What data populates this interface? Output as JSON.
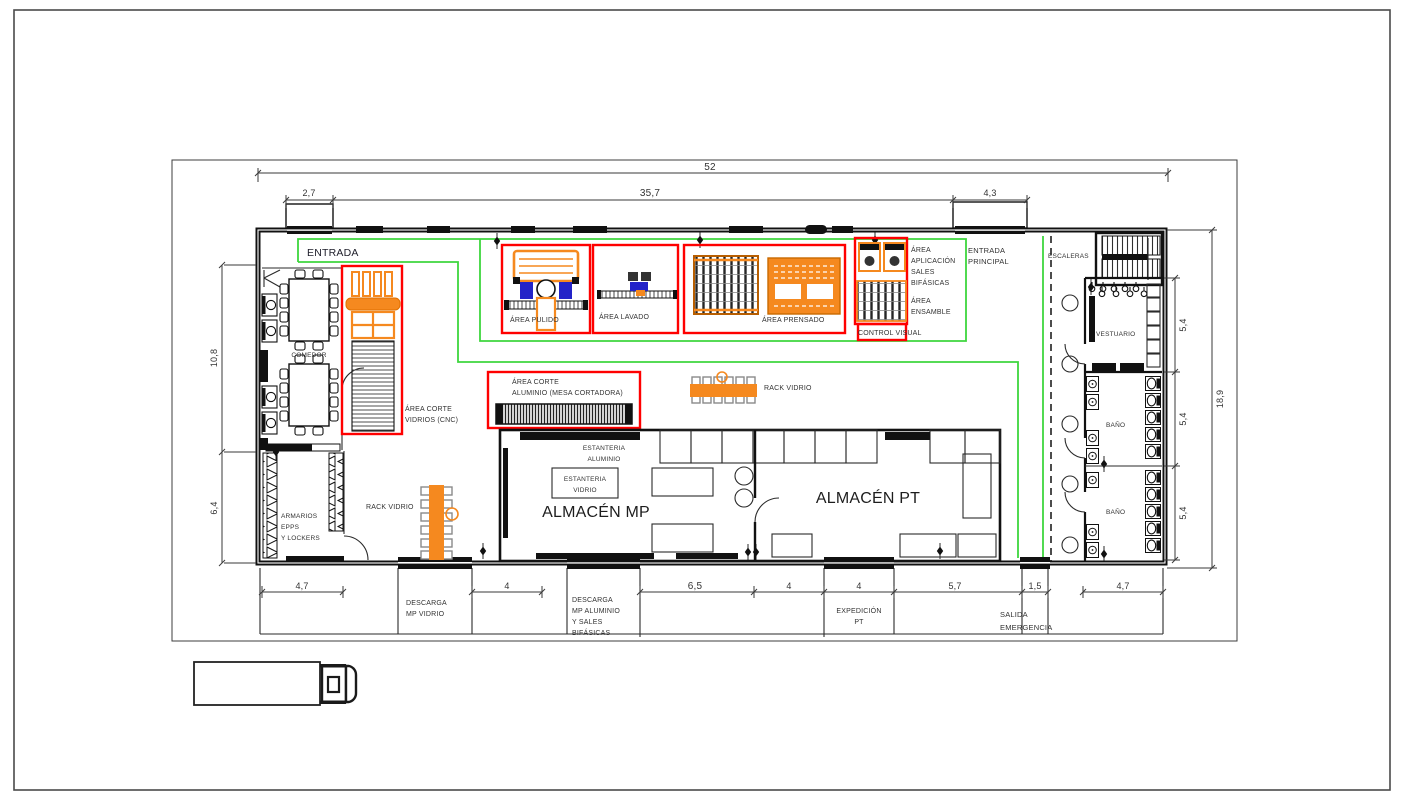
{
  "plan_title": "Planta industrial - distribución de áreas",
  "labels": {
    "entrada": "ENTRADA",
    "comedor": "COMEDOR",
    "armarios": [
      "ARMARIOS",
      "EPPS",
      "Y LOCKERS"
    ],
    "entrada_principal": [
      "ENTRADA",
      "PRINCIPAL"
    ],
    "escaleras": "ESCALERAS",
    "vestuario": "VESTUARIO",
    "bano_1": "BAÑO",
    "bano_2": "BAÑO"
  },
  "areas": {
    "pulido": "ÁREA PULIDO",
    "lavado": "ÁREA LAVADO",
    "prensado": "ÁREA PRENSADO",
    "control_visual": "CONTROL VISUAL",
    "aplicacion_sales": [
      "ÁREA",
      "APLICACIÓN",
      "SALES",
      "BIFÁSICAS"
    ],
    "ensamble": [
      "ÁREA",
      "ENSAMBLE"
    ],
    "corte_vidrios": [
      "ÁREA CORTE",
      "VIDRIOS (CNC)"
    ],
    "corte_aluminio": [
      "ÁREA CORTE",
      "ALUMINIO (MESA CORTADORA)"
    ]
  },
  "storage": {
    "almacen_mp": "ALMACÉN MP",
    "almacen_pt": "ALMACÉN PT",
    "estanteria_aluminio": [
      "ESTANTERIA",
      "ALUMINIO"
    ],
    "estanteria_vidrio": [
      "ESTANTERIA",
      "VIDRIO"
    ],
    "rack_vidrio_1": "RACK VIDRIO",
    "rack_vidrio_2": "RACK VIDRIO"
  },
  "exterior": {
    "descarga_vidrio": [
      "DESCARGA",
      "MP VIDRIO"
    ],
    "descarga_aluminio": [
      "DESCARGA",
      "MP ALUMINIO",
      "Y SALES",
      "BIFÁSICAS"
    ],
    "expedicion": [
      "EXPEDICIÓN",
      "PT"
    ],
    "salida_emergencia": [
      "SALIDA",
      "EMERGENCIA"
    ]
  },
  "dimensions": {
    "top": {
      "total": "52",
      "seg1": "2,7",
      "seg2": "35,7",
      "seg3": "4,3"
    },
    "left": {
      "upper": "10,8",
      "lower": "6,4"
    },
    "right": {
      "r1": "5,4",
      "r2": "5,4",
      "r3": "5,4",
      "total": "18,9"
    },
    "bottom": {
      "b1": "4,7",
      "b2": "4",
      "b3": "6,5",
      "b4": "4",
      "b5": "4",
      "b6": "5,7",
      "b7": "1,5",
      "b8": "4,7"
    }
  },
  "colors": {
    "wall": "#111111",
    "highlight_red": "#ff0000",
    "route_green": "#3ed63e",
    "equipment_orange": "#f5891f",
    "equipment_blue": "#2323c8",
    "text": "#2d2d2d"
  }
}
